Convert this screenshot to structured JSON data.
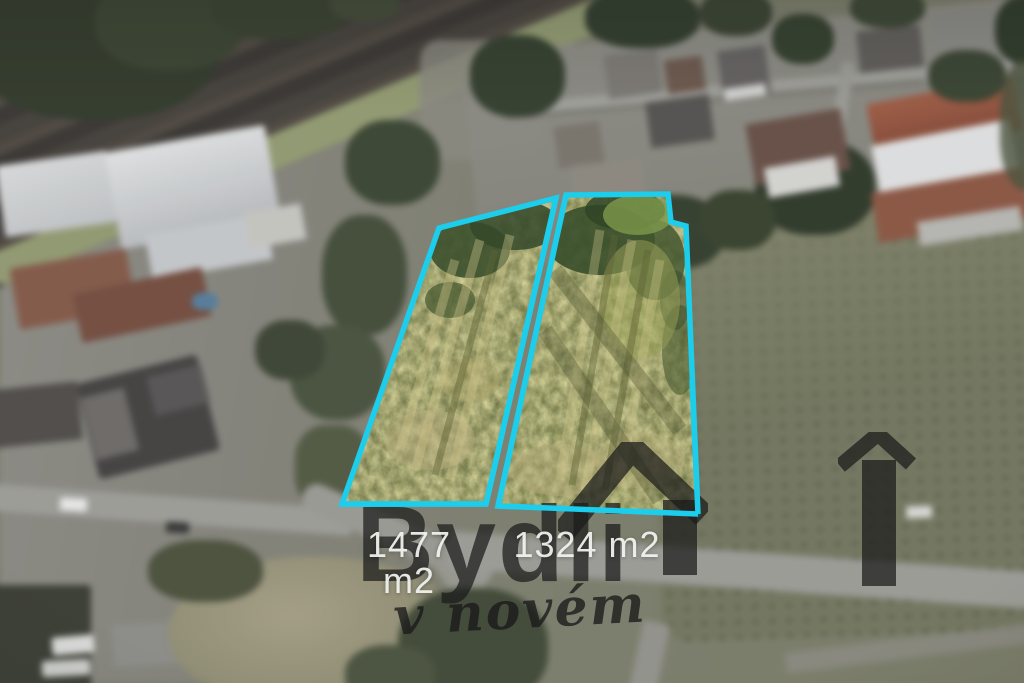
{
  "overlay": {
    "parcels": [
      {
        "area_label": "1477 m2"
      },
      {
        "area_label": "1324 m2"
      }
    ],
    "outline_color": "#1ccdec",
    "label_color": "#f2f2ef",
    "watermark": {
      "brand": "Bydli",
      "tagline": "v novém",
      "color": "#1a1a1a",
      "icons": [
        "house-roof-icon",
        "house-bar-icon"
      ]
    }
  }
}
